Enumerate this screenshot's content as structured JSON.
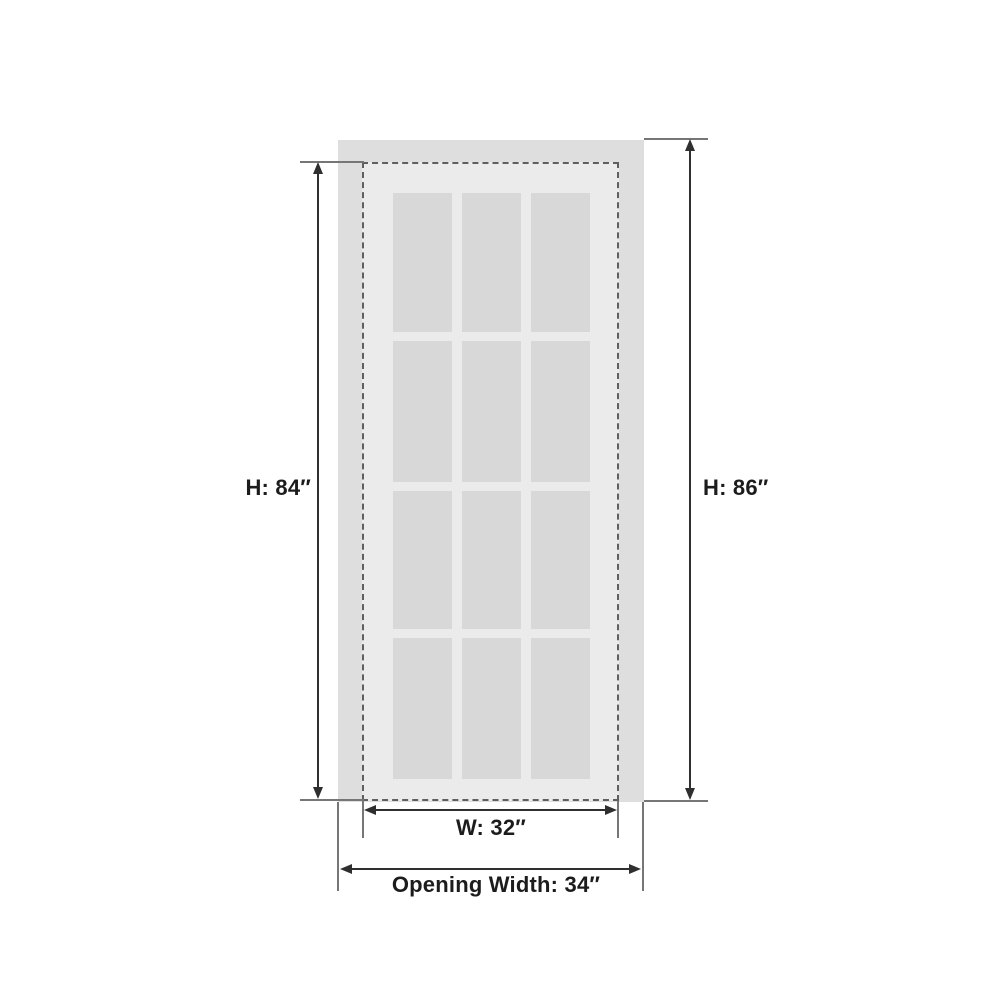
{
  "diagram": {
    "labels": {
      "door_height": "H: 84″",
      "opening_height": "H: 86″",
      "door_width": "W: 32″",
      "opening_width": "Opening Width: 34″"
    },
    "dimensions": {
      "door_height_in": 84,
      "opening_height_in": 86,
      "door_width_in": 32,
      "opening_width_in": 34
    },
    "door": {
      "glass_columns": 3,
      "glass_rows": 4,
      "pane_count": 12
    },
    "colors": {
      "background": "#ffffff",
      "opening_fill": "#dedede",
      "door_fill": "#ebebeb",
      "pane_fill": "#d8d8d8",
      "dash_color": "#5f5f5f",
      "tick_color": "#767676",
      "line_color": "#2f2f2f",
      "text_color": "#1c1c1c"
    }
  }
}
